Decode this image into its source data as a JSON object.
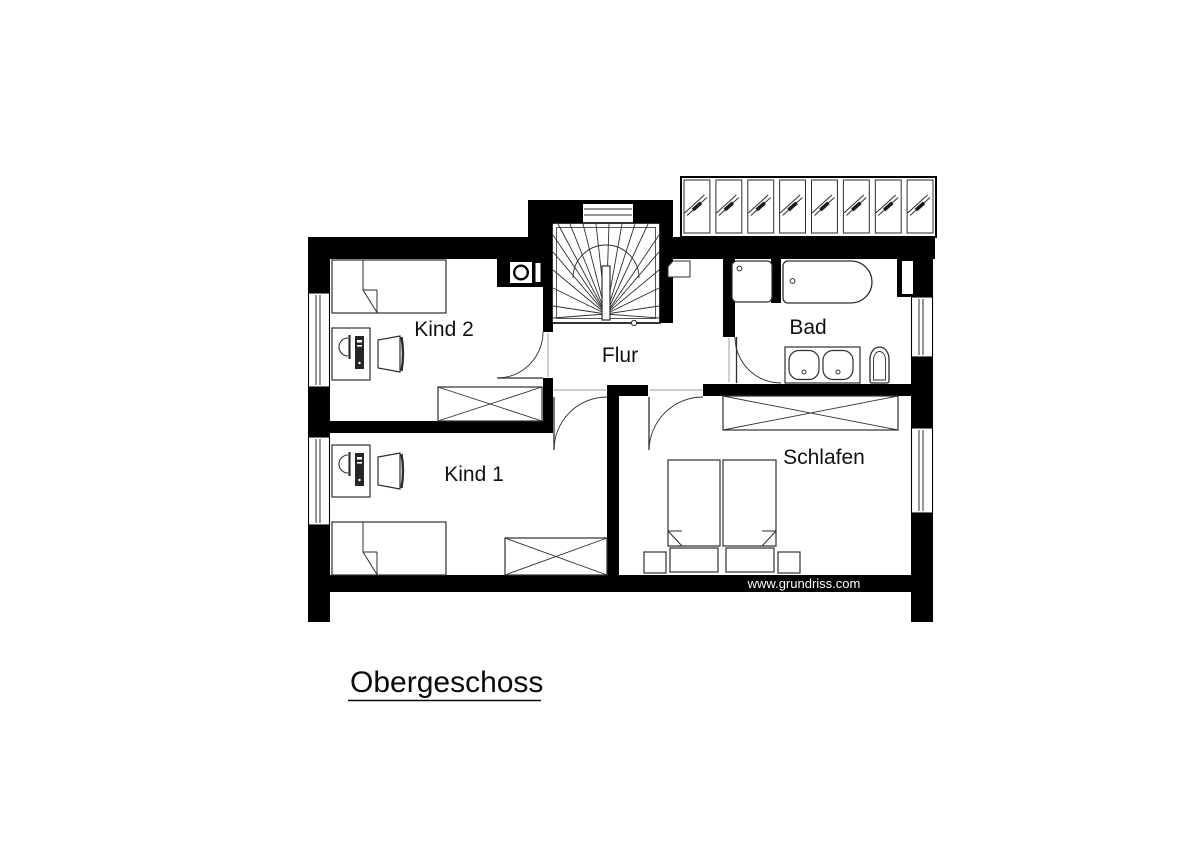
{
  "plan": {
    "floor_title": "Obergeschoss",
    "watermark": "www.grundriss.com",
    "room_labels": {
      "kind2": "Kind 2",
      "kind1": "Kind 1",
      "flur": "Flur",
      "bad": "Bad",
      "schlafen": "Schlafen"
    },
    "colors": {
      "walls": "#000000",
      "lines": "#2e2e2e",
      "background": "#ffffff"
    },
    "symbols": {
      "roof_window_cell": "glass-pane-diagonal-icon",
      "stairs": "winder-staircase-icon",
      "beds": "bed-with-folded-blanket-icon",
      "desk": "desk-with-monitor-and-pc-icon",
      "wardrobe": "crossed-box-wardrobe-icon",
      "bath": [
        "shower-icon",
        "bathtub-icon",
        "double-washbasin-icon",
        "toilet-icon"
      ],
      "doors": "quarter-circle-door-swing-icon",
      "chimney": "chimney-ring-icon",
      "window": "double-line-window-icon"
    }
  }
}
